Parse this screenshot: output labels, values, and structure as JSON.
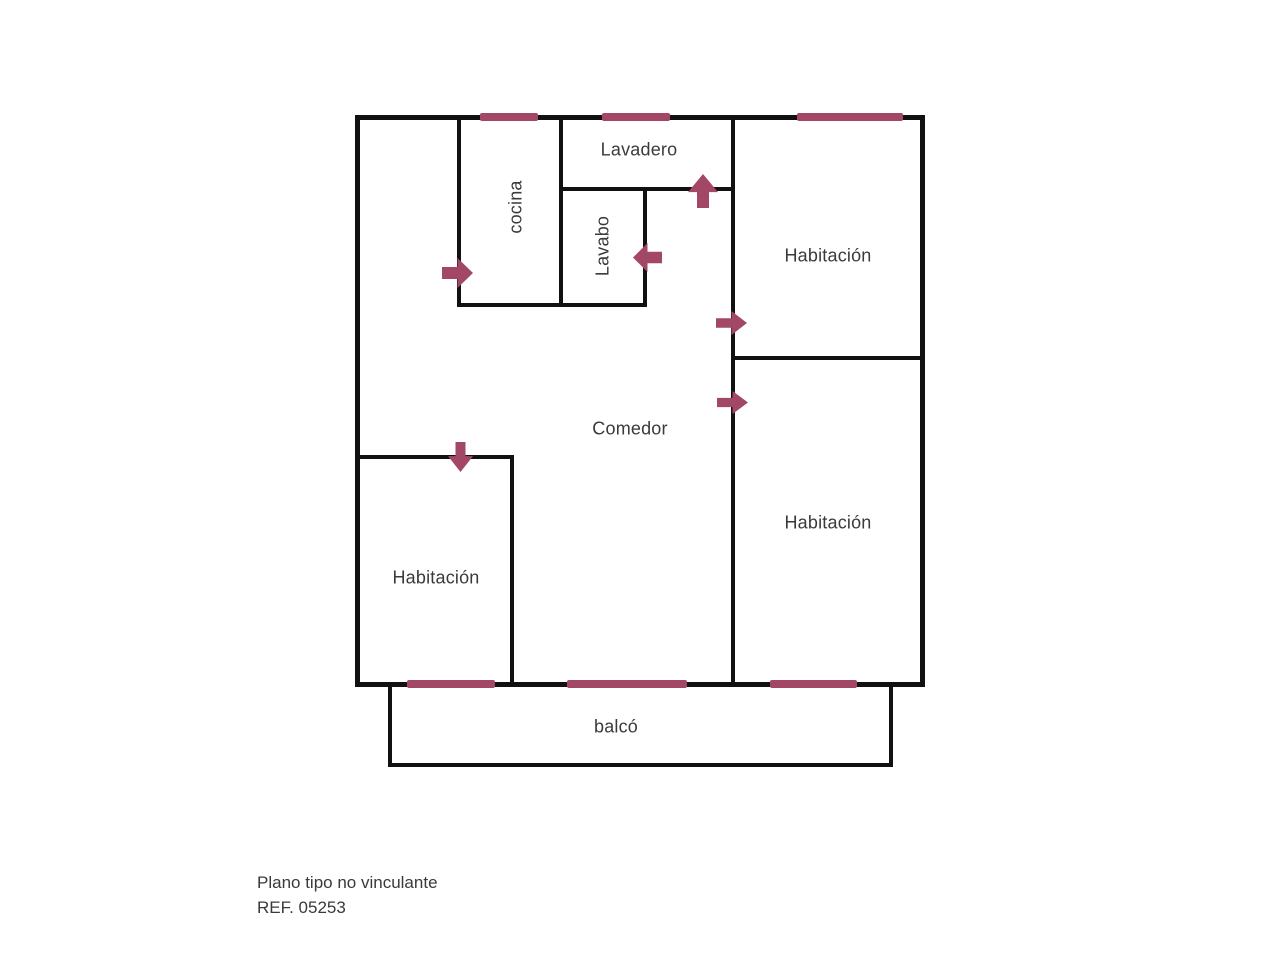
{
  "title": "Plano de vivienda",
  "colors": {
    "background": "#ffffff",
    "wall": "#111111",
    "accent": "#a24765",
    "text": "#3a3a3a"
  },
  "footer": {
    "line1": "Plano tipo no vinculante",
    "line2": "REF. 05253"
  },
  "floorplan": {
    "labels": [
      {
        "name": "label-lavadero",
        "text": "Lavadero",
        "cx": 639,
        "cy": 150,
        "rotated": false
      },
      {
        "name": "label-cocina",
        "text": "cocina",
        "cx": 516,
        "cy": 207,
        "rotated": true
      },
      {
        "name": "label-lavabo",
        "text": "Lavabo",
        "cx": 603,
        "cy": 246,
        "rotated": true
      },
      {
        "name": "label-habitacion-top-right",
        "text": "Habitación",
        "cx": 828,
        "cy": 256,
        "rotated": false
      },
      {
        "name": "label-comedor",
        "text": "Comedor",
        "cx": 630,
        "cy": 429,
        "rotated": false
      },
      {
        "name": "label-habitacion-bottom-right",
        "text": "Habitación",
        "cx": 828,
        "cy": 523,
        "rotated": false
      },
      {
        "name": "label-habitacion-left",
        "text": "Habitación",
        "cx": 436,
        "cy": 578,
        "rotated": false
      },
      {
        "name": "label-balco",
        "text": "balcó",
        "cx": 616,
        "cy": 727,
        "rotated": false
      }
    ],
    "walls": [
      {
        "name": "outer-top",
        "x": 355,
        "y": 115,
        "w": 570,
        "h": 5
      },
      {
        "name": "outer-left",
        "x": 355,
        "y": 115,
        "w": 5,
        "h": 572
      },
      {
        "name": "outer-right",
        "x": 920,
        "y": 115,
        "w": 5,
        "h": 572
      },
      {
        "name": "outer-bottom",
        "x": 355,
        "y": 682,
        "w": 570,
        "h": 5
      },
      {
        "name": "cocina-left",
        "x": 457,
        "y": 115,
        "w": 4,
        "h": 192
      },
      {
        "name": "cocina-lavabo-bottom",
        "x": 457,
        "y": 303,
        "w": 190,
        "h": 4
      },
      {
        "name": "cocina-right",
        "x": 559,
        "y": 115,
        "w": 4,
        "h": 192
      },
      {
        "name": "lavadero-bottom",
        "x": 559,
        "y": 187,
        "w": 176,
        "h": 4
      },
      {
        "name": "lavabo-right",
        "x": 643,
        "y": 187,
        "w": 4,
        "h": 120
      },
      {
        "name": "comedor-right",
        "x": 731,
        "y": 115,
        "w": 4,
        "h": 572
      },
      {
        "name": "habitacion-divider",
        "x": 731,
        "y": 356,
        "w": 194,
        "h": 4
      },
      {
        "name": "left-habitacion-top",
        "x": 355,
        "y": 455,
        "w": 159,
        "h": 4
      },
      {
        "name": "left-habitacion-right",
        "x": 510,
        "y": 455,
        "w": 4,
        "h": 232
      },
      {
        "name": "balcony-left",
        "x": 388,
        "y": 687,
        "w": 4,
        "h": 80
      },
      {
        "name": "balcony-right",
        "x": 889,
        "y": 687,
        "w": 4,
        "h": 80
      },
      {
        "name": "balcony-bottom",
        "x": 388,
        "y": 763,
        "w": 505,
        "h": 4
      }
    ],
    "windows": [
      {
        "name": "window-cocina",
        "x": 480,
        "y": 113,
        "w": 58,
        "h": 8
      },
      {
        "name": "window-lavadero",
        "x": 602,
        "y": 113,
        "w": 68,
        "h": 8
      },
      {
        "name": "window-habitacion-top",
        "x": 797,
        "y": 113,
        "w": 106,
        "h": 8
      },
      {
        "name": "window-habitacion-left",
        "x": 407,
        "y": 680,
        "w": 88,
        "h": 8
      },
      {
        "name": "window-comedor",
        "x": 567,
        "y": 680,
        "w": 120,
        "h": 8
      },
      {
        "name": "window-habitacion-bottom",
        "x": 770,
        "y": 680,
        "w": 87,
        "h": 8
      }
    ],
    "doors": [
      {
        "name": "door-cocina",
        "dir": "right",
        "x": 442,
        "y": 258,
        "w": 31,
        "h": 30
      },
      {
        "name": "door-lavabo",
        "dir": "left",
        "x": 633,
        "y": 243,
        "w": 29,
        "h": 29
      },
      {
        "name": "door-lavadero",
        "dir": "up",
        "x": 688,
        "y": 174,
        "w": 30,
        "h": 34
      },
      {
        "name": "door-habitacion-top",
        "dir": "right",
        "x": 716,
        "y": 311,
        "w": 31,
        "h": 24
      },
      {
        "name": "door-habitacion-bottom",
        "dir": "right",
        "x": 717,
        "y": 391,
        "w": 31,
        "h": 23
      },
      {
        "name": "door-habitacion-left",
        "dir": "down",
        "x": 448,
        "y": 442,
        "w": 25,
        "h": 30
      }
    ]
  }
}
